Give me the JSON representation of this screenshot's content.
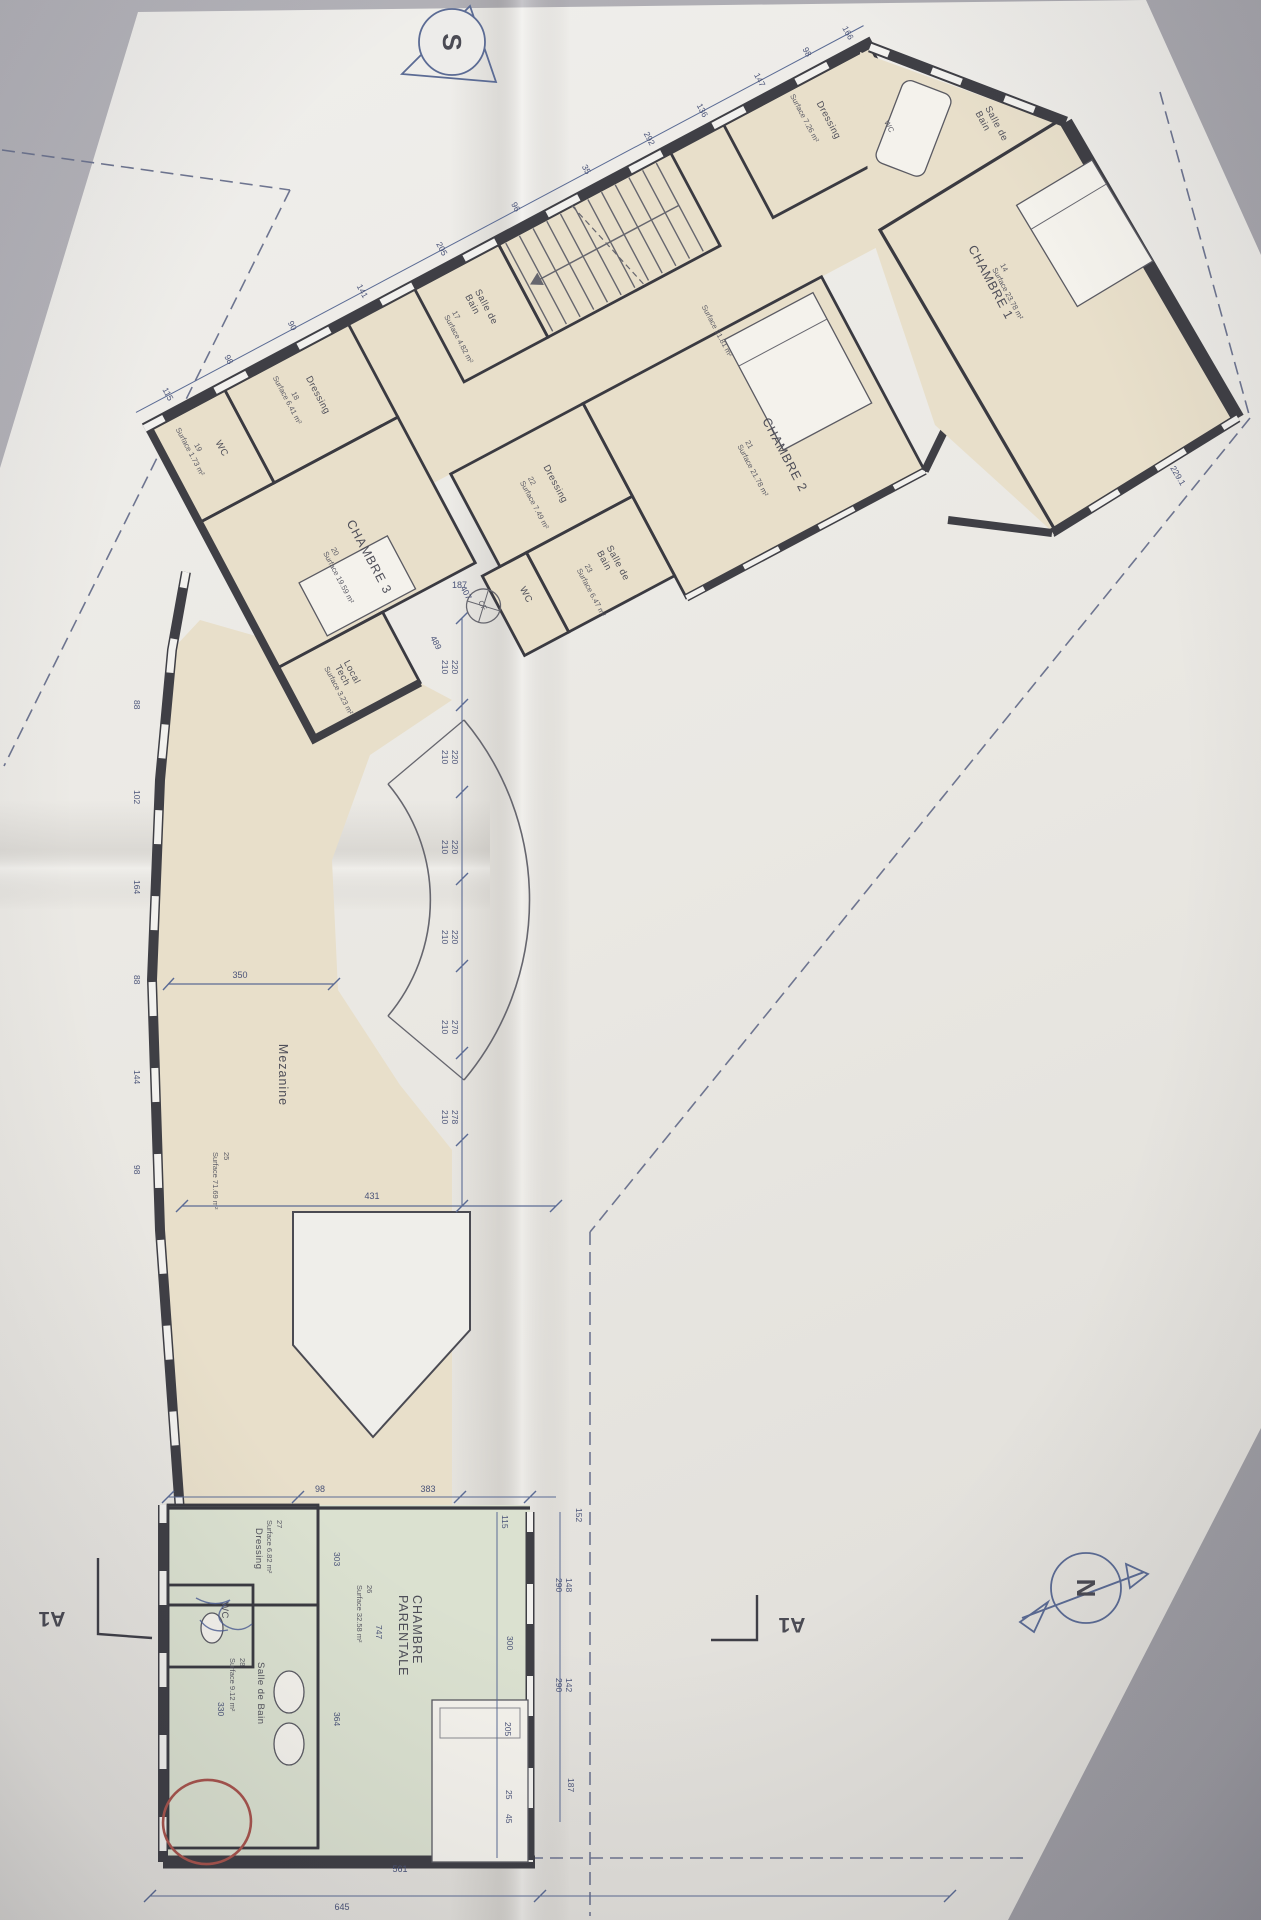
{
  "colors": {
    "photo_background": "#a9a8ae",
    "paper": "#ebe9e4",
    "plan_beige": "#e8dfca",
    "plan_green": "#dbe1d0",
    "wall_ink": "#3a3a41",
    "dimension_blue": "#5b6b94",
    "pen_blue": "#4b5c94",
    "red_annotation": "#a8544d"
  },
  "compass": {
    "south": "S",
    "north": "N"
  },
  "section_markers": {
    "left": "A1",
    "right": "A1"
  },
  "rooms": {
    "chambre1": {
      "name": "CHAMBRE 1",
      "num": "14",
      "surface": "Surface 23.78 m²"
    },
    "chambre2": {
      "name": "CHAMBRE 2",
      "num": "21",
      "surface": "Surface 21.78 m²"
    },
    "chambre3": {
      "name": "CHAMBRE 3",
      "num": "20",
      "surface": "Surface 19.59 m²"
    },
    "parentale": {
      "line1": "CHAMBRE",
      "line2": "PARENTALE",
      "num": "26",
      "surface": "Surface 32.58 m²"
    },
    "mezzanine": {
      "name": "Mezanine",
      "num": "25",
      "surface": "Surface 71.69 m²"
    },
    "sdb15": {
      "l1": "Salle de",
      "l2": "Bain"
    },
    "wc15": {
      "name": "WC"
    },
    "dressing16": {
      "name": "Dressing",
      "surface": "Surface 7.26 m²"
    },
    "sdb17": {
      "l1": "Salle de",
      "l2": "Bain",
      "num": "17",
      "surface": "Surface 4.82 m²"
    },
    "dressing18": {
      "name": "Dressing",
      "num": "18",
      "surface": "Surface 6.41 m²"
    },
    "wc19": {
      "name": "WC",
      "num": "19",
      "surface": "Surface 1.73 m²"
    },
    "dressing22": {
      "name": "Dressing",
      "num": "22",
      "surface": "Surface 7.49 m²"
    },
    "sdb23": {
      "l1": "Salle de",
      "l2": "Bain",
      "num": "23",
      "surface": "Surface 6.47 m²"
    },
    "wc_corridor": {
      "name": "WC"
    },
    "localtech": {
      "l1": "Local",
      "l2": "Tech",
      "surface": "Surface 3.23 m²"
    },
    "degagement": {
      "surface": "Surface 21.81 m²"
    },
    "dressing27": {
      "name": "Dressing",
      "num": "27",
      "surface": "Surface 6.82 m²"
    },
    "sdb28": {
      "name": "Salle de Bain",
      "num": "28",
      "surface": "Surface 9.12 m²"
    },
    "cf": {
      "label": "CF"
    }
  },
  "dims": {
    "top_wall": [
      "115",
      "98",
      "90",
      "141",
      "205",
      "96",
      "35",
      "292",
      "136",
      "147",
      "98",
      "166"
    ],
    "chambre3": [
      "407",
      "489"
    ],
    "corridor_width": "187",
    "chambre1_side": "229.1",
    "mezzanine_width": "350",
    "mezzanine_length": "431",
    "right_chain": [
      [
        "220",
        "210"
      ],
      [
        "220",
        "210"
      ],
      [
        "220",
        "210"
      ],
      [
        "220",
        "210"
      ],
      [
        "270",
        "210"
      ],
      [
        "278",
        "210"
      ]
    ],
    "left_chain": [
      "88",
      "102",
      "164",
      "88",
      "144",
      "98"
    ],
    "suite_top": [
      "98",
      "383",
      "115",
      "152"
    ],
    "suite_right_pairs": [
      [
        "148",
        "290"
      ],
      [
        "142",
        "290"
      ]
    ],
    "suite_right_singles": [
      "187",
      "300",
      "205",
      "25",
      "45"
    ],
    "suite_inner": [
      "303",
      "747",
      "364",
      "330"
    ],
    "suite_bottom": [
      "561",
      "645"
    ]
  }
}
